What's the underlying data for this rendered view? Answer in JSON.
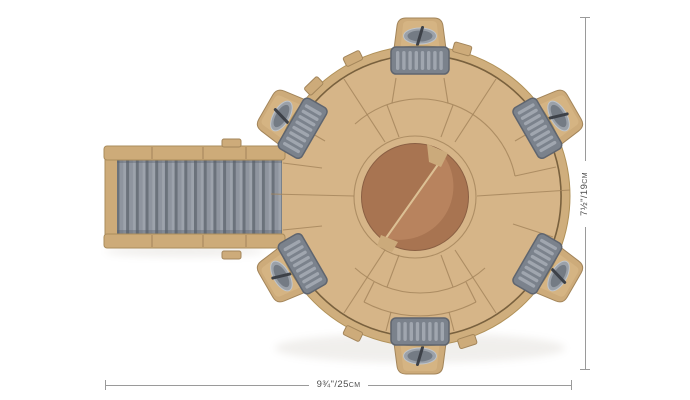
{
  "annotations": {
    "width_dimension": {
      "label": "9¾\"/25cm"
    },
    "height_dimension": {
      "label": "7½\"/19cm"
    }
  },
  "colors": {
    "background": "#ffffff",
    "deck": "#d6b588",
    "outer_band": "#cfae7d",
    "edge": "#b09158",
    "rim_line": "#6f5836",
    "seam": "#a2835a",
    "foot": "#cdab7a",
    "foot_stroke": "#a3855a",
    "foot_top": "#d6b584",
    "oval_outer": "#9ba1a9",
    "oval_inner": "#747b84",
    "oval_slash": "#3d4148",
    "oval_ring": "#c0c5ca",
    "pad": "#7b828c",
    "pad_stroke": "#5f656f",
    "rib": "#a0a6af",
    "ramp_rail": "#cdab79",
    "rail_stroke": "#aa8c5c",
    "ramp_groove": "#6b727b",
    "ramp_face": "#8f959f",
    "ramp_hi": "#9da3ac",
    "disc_dark": "#a87451",
    "disc_light": "#b8835e",
    "disc_tab": "#cbaa7b",
    "disc_seam": "#dcc094",
    "disc_edge": "#8a5f43",
    "shadow": "#8b7f6d",
    "dim_line": "#9a9a9a",
    "dim_text": "#4d4d4d"
  }
}
